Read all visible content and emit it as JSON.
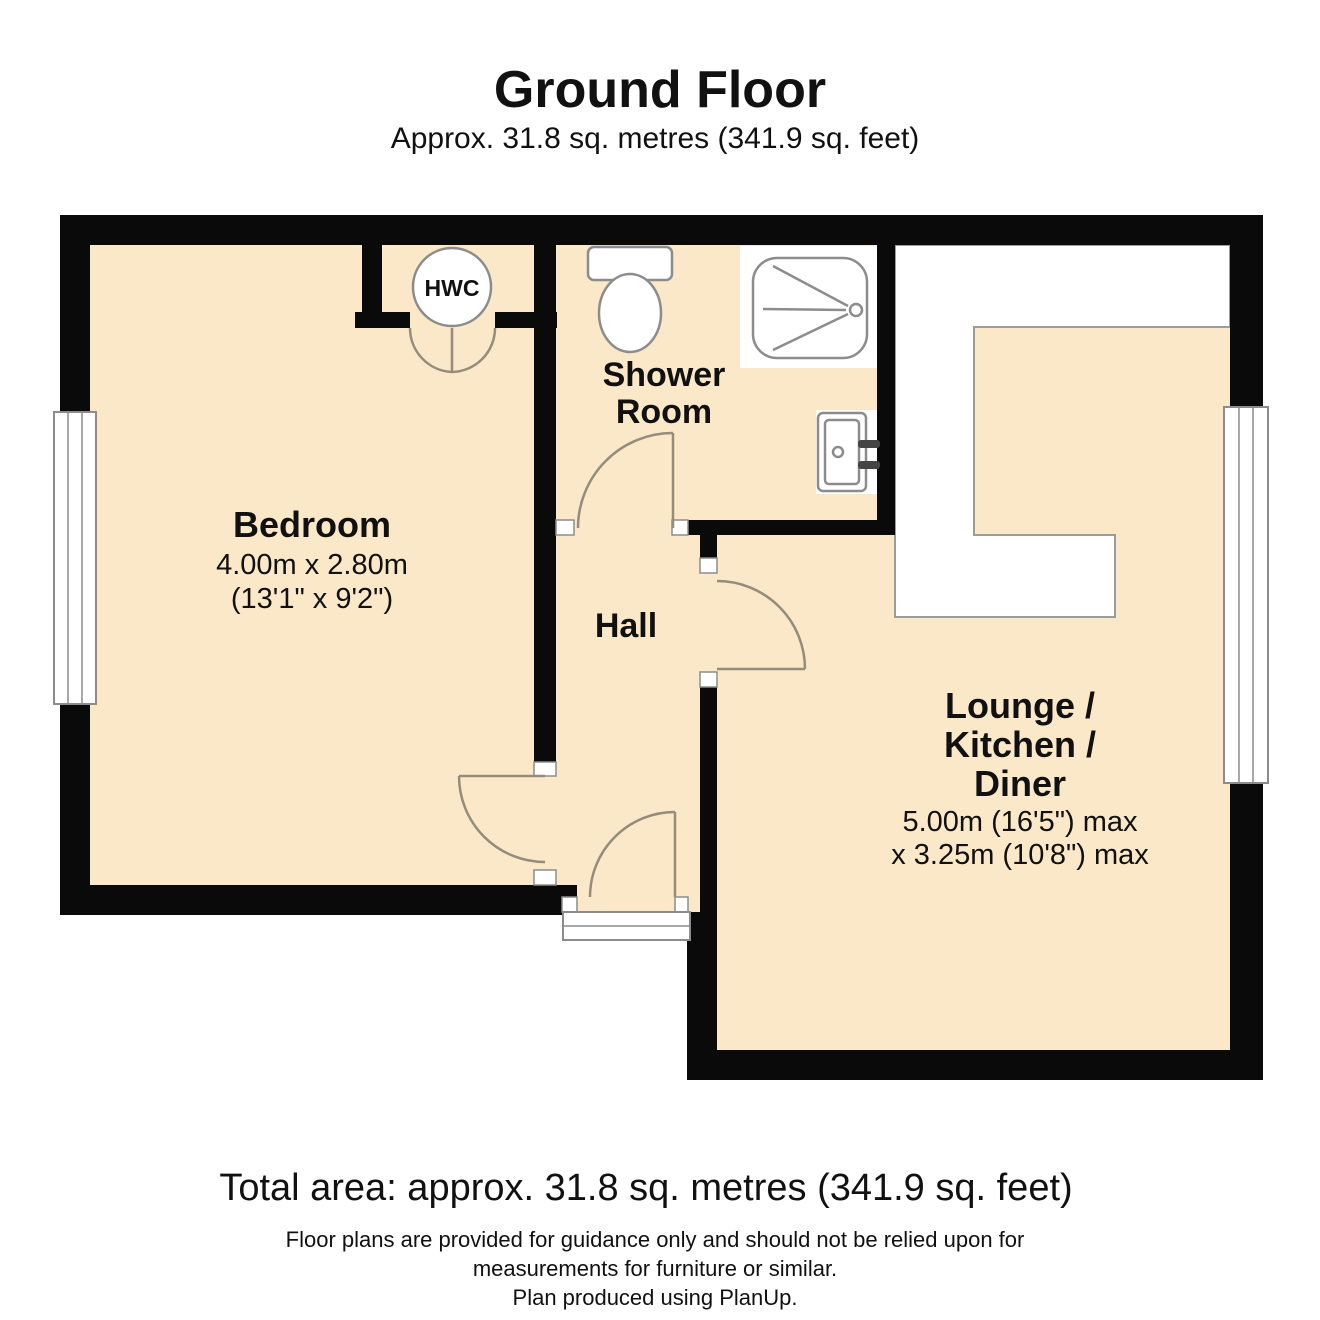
{
  "header": {
    "title": "Ground Floor",
    "subtitle": "Approx. 31.8 sq. metres (341.9 sq. feet)"
  },
  "rooms": {
    "bedroom": {
      "name": "Bedroom",
      "dims_metric": "4.00m x 2.80m",
      "dims_imperial": "(13'1\" x 9'2\")"
    },
    "shower_room": {
      "name_line1": "Shower",
      "name_line2": "Room"
    },
    "hall": {
      "name": "Hall"
    },
    "lounge": {
      "name_line1": "Lounge /",
      "name_line2": "Kitchen /",
      "name_line3": "Diner",
      "dims_line1": "5.00m (16'5\") max",
      "dims_line2": "x 3.25m (10'8\") max"
    },
    "hwc": {
      "label": "HWC"
    }
  },
  "footer": {
    "total_area": "Total area: approx. 31.8 sq. metres (341.9 sq. feet)",
    "disclaimer_line1": "Floor plans are provided for guidance only and should not be relied upon for",
    "disclaimer_line2": "measurements for furniture or similar.",
    "disclaimer_line3": "Plan produced using PlanUp."
  },
  "colors": {
    "floor": "#FAE8C9",
    "wall": "#0A0A0A",
    "fixture_outline": "#8C8C8C",
    "door_arc": "#958D7B"
  }
}
